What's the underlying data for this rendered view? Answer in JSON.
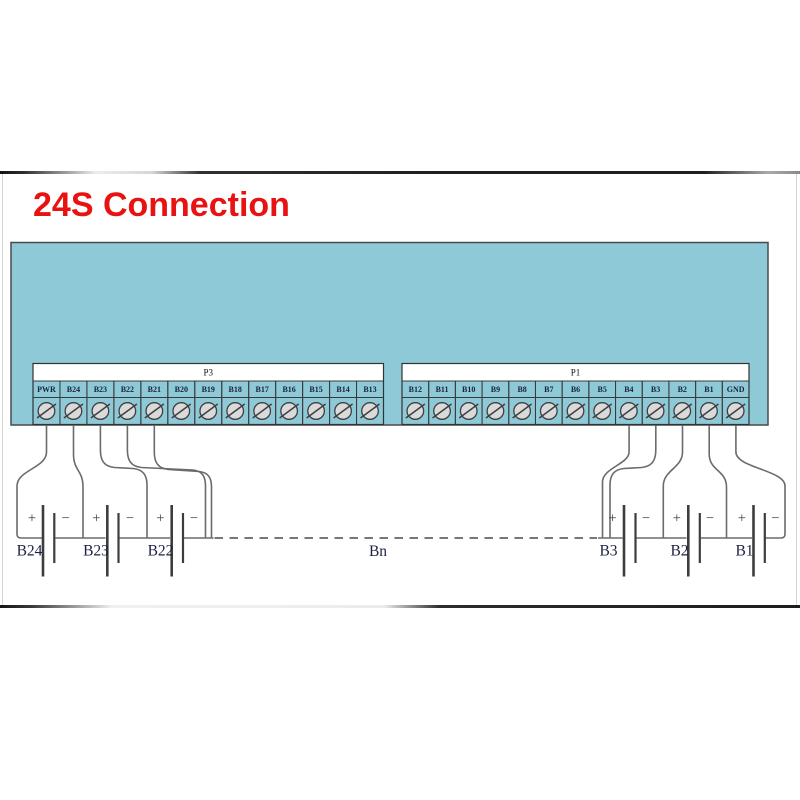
{
  "title": {
    "text": "24S Connection",
    "color": "#e81212"
  },
  "board": {
    "color": "#8ec9d8",
    "border_color": "#4a4a4a"
  },
  "connectors": [
    {
      "name": "P3",
      "side": "left",
      "terminals": [
        "PWR",
        "B24",
        "B23",
        "B22",
        "B21",
        "B20",
        "B19",
        "B18",
        "B17",
        "B16",
        "B15",
        "B14",
        "B13"
      ]
    },
    {
      "name": "P1",
      "side": "right",
      "terminals": [
        "B12",
        "B11",
        "B10",
        "B9",
        "B8",
        "B7",
        "B6",
        "B5",
        "B4",
        "B3",
        "B2",
        "B1",
        "GND"
      ]
    }
  ],
  "batteries": {
    "left": [
      "B24",
      "B23",
      "B22"
    ],
    "right": [
      "B3",
      "B2",
      "B1"
    ],
    "elided": "Bn",
    "plus_symbol": "+",
    "minus_symbol": "−"
  },
  "icon_names": {
    "screw": "screw-terminal-icon"
  },
  "wire_color": "#6b6b6b",
  "plate_color": "#3d3d3d",
  "label_color": "#1b2140"
}
